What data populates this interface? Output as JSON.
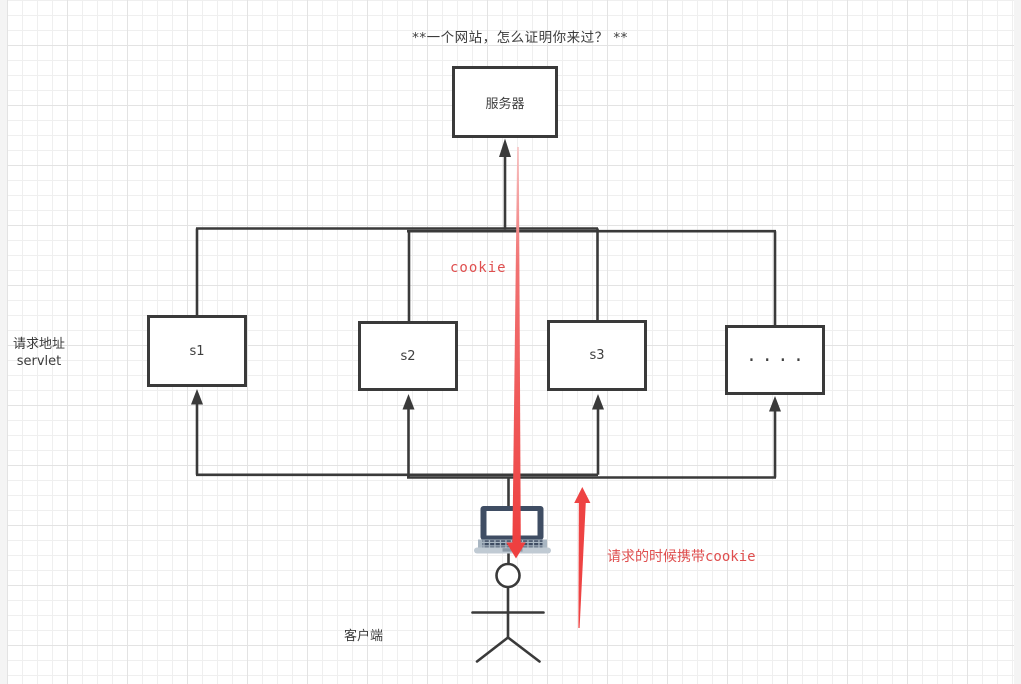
{
  "title": {
    "text": "**一个网站，怎么证明你来过？ **"
  },
  "nodes": {
    "server": {
      "label": "服务器"
    },
    "s1": {
      "label": "s1"
    },
    "s2": {
      "label": "s2"
    },
    "s3": {
      "label": "s3"
    },
    "more": {
      "label": "····"
    }
  },
  "labels": {
    "request_address_line1": "请求地址",
    "request_address_line2": "servlet",
    "client": "客户端"
  },
  "annotations": {
    "cookie": "cookie",
    "carry_cookie": "请求的时候携带cookie"
  },
  "icons": {
    "laptop": "laptop-icon",
    "person": "stick-figure-icon"
  },
  "colors": {
    "line": "#3a3a3a",
    "red_arrow": "#ee4343",
    "red_text": "#df4f4f",
    "laptop_dark": "#3f4d63",
    "laptop_base": "#a9b6c2",
    "grid_minor": "#efefef",
    "grid_major": "#e3e3e3"
  }
}
